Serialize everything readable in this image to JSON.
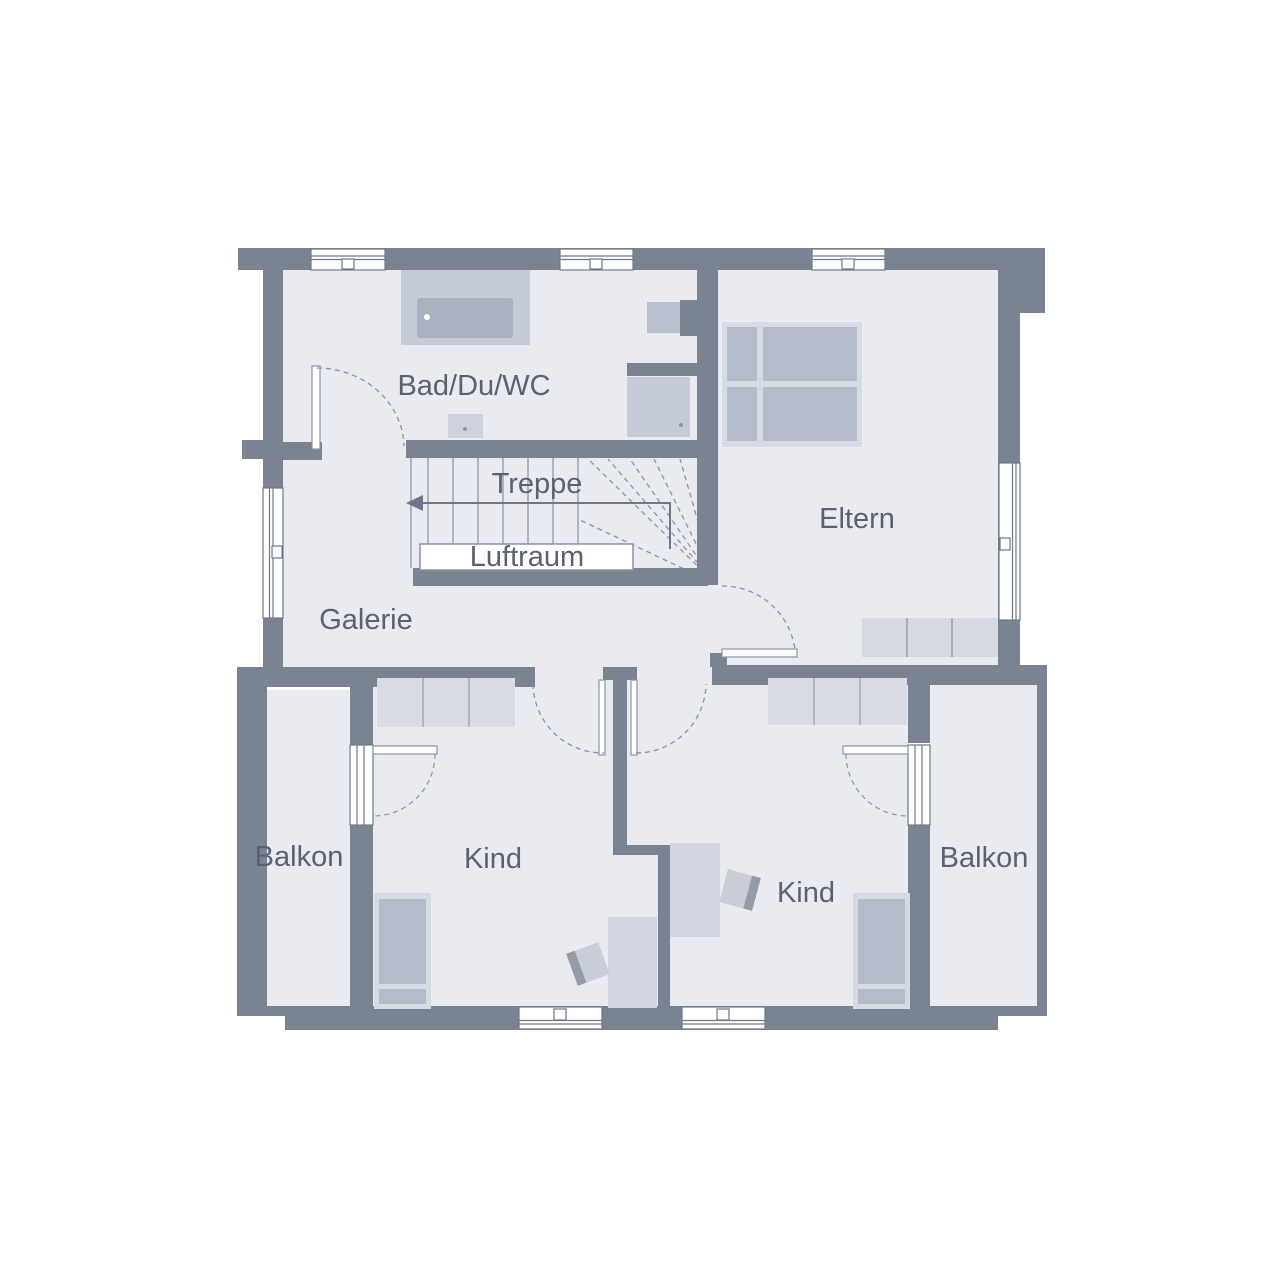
{
  "plan": {
    "type": "floor-plan",
    "rooms": {
      "bad": {
        "label": "Bad/Du/WC"
      },
      "treppe": {
        "label": "Treppe"
      },
      "luftraum": {
        "label": "Luftraum"
      },
      "eltern": {
        "label": "Eltern"
      },
      "galerie": {
        "label": "Galerie"
      },
      "balkon_links": {
        "label": "Balkon"
      },
      "kind_links": {
        "label": "Kind"
      },
      "kind_rechts": {
        "label": "Kind"
      },
      "balkon_rechts": {
        "label": "Balkon"
      }
    },
    "colors": {
      "background": "#ffffff",
      "wall": "#7a8392",
      "floor": "#e9ebf0",
      "furniture_light": "#d6dae3",
      "furniture_mid": "#b4bbc9",
      "fixture": "#c5cbd7",
      "fixture_dark": "#a9b1c1",
      "symbol_stroke": "#8b93a3",
      "arrow": "#6e7787",
      "text": "#5a616f"
    }
  }
}
